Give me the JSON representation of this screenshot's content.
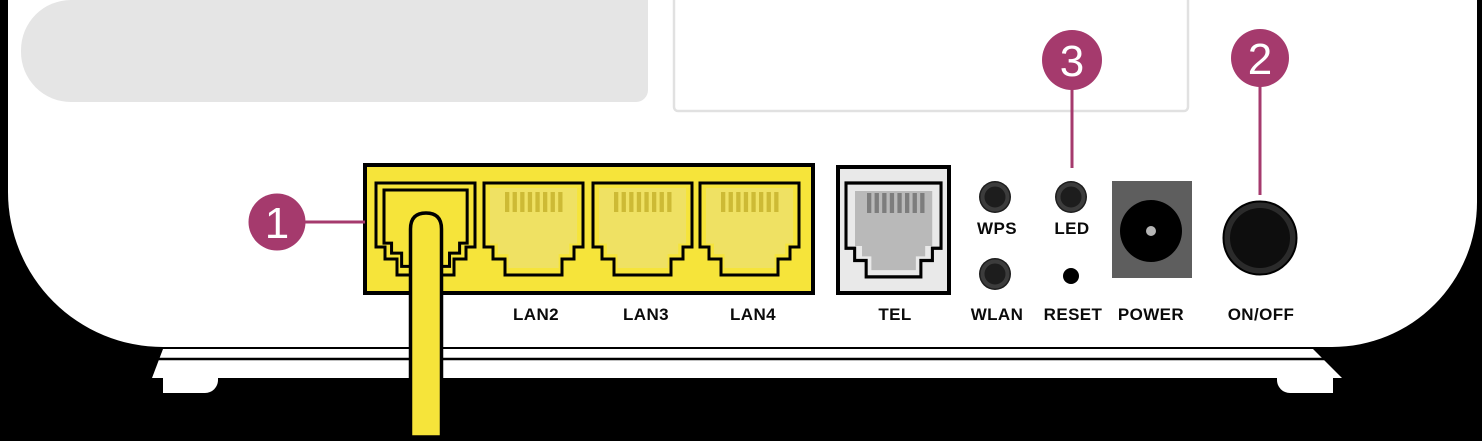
{
  "diagram": {
    "subject": "router-rear-panel"
  },
  "callouts": [
    {
      "number": "1"
    },
    {
      "number": "2"
    },
    {
      "number": "3"
    }
  ],
  "ports": {
    "lan2": "LAN2",
    "lan3": "LAN3",
    "lan4": "LAN4",
    "tel": "TEL"
  },
  "controls": {
    "wps": "WPS",
    "wlan": "WLAN",
    "led": "LED",
    "reset": "RESET",
    "power": "POWER",
    "onoff": "ON/OFF"
  },
  "colors": {
    "accent": "#A53A6D",
    "port_yellow": "#F6E43A",
    "port_inner_yellow": "#EFE163",
    "pin_yellow": "#CDBA35",
    "tel_panel_gray": "#E9E9E9",
    "tel_inner_gray": "#B9B9B9",
    "tel_pin_gray": "#7D7D7D",
    "power_block_gray": "#5E5E5E",
    "background": "#000000",
    "body_white": "#FFFFFF"
  }
}
